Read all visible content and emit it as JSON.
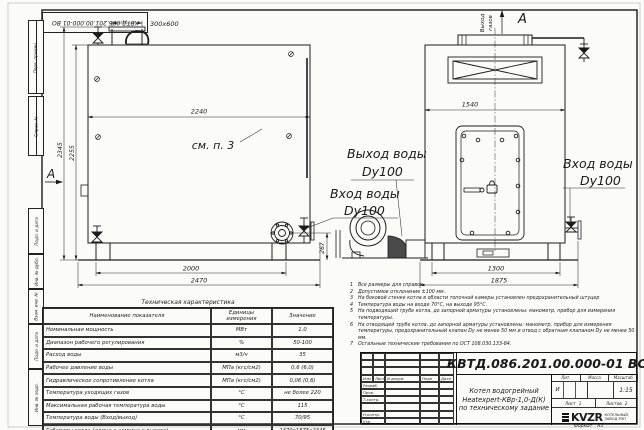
{
  "doc": {
    "number": "КВТД.086.201.00.000-01 ВО",
    "format_label": "Формат",
    "format_value": "А3"
  },
  "margin_labels": {
    "perv_primen": "Перв. примен.",
    "sprav_no": "Справ. №",
    "podp_data_1": "Подп. и дата",
    "inv_dubl": "Инв. № дубл.",
    "vzam_inv": "Взам. инв. №",
    "podp_data_2": "Подп. и дата",
    "inv_podl": "Инв. № подл."
  },
  "drawing": {
    "left_view": {
      "dim_chimney": "300x600",
      "dim_top_width": "2240",
      "see_note": "см. п. 3",
      "dim_height_outer": "2345",
      "dim_height_inner": "2255",
      "view_mark": "А",
      "dim_bottom_inner": "2000",
      "dim_bottom_outer": "2470",
      "dim_flange_height": "267"
    },
    "right_view": {
      "gas_outlet_line1": "Выход",
      "gas_outlet_line2": "газов",
      "view_label": "А",
      "dim_top_width": "1540",
      "dim_bottom_inner": "1300",
      "dim_bottom_outer": "1875"
    },
    "callouts": {
      "water_outlet": "Выход воды",
      "water_outlet_dn": "Dy100",
      "water_inlet_left": "Вход воды",
      "water_inlet_left_dn": "Dy100",
      "water_inlet_right": "Вход воды",
      "water_inlet_right_dn": "Dy100"
    }
  },
  "notes": [
    {
      "n": "1",
      "text": "Все размеры для справок"
    },
    {
      "n": "2",
      "text": "Допустимое отклонение ±100 мм."
    },
    {
      "n": "3",
      "text": "На боковой стенке котла в области топочной камеры установлен предохранительный штуцер"
    },
    {
      "n": "4",
      "text": "Температура воды на входе 70°С, на выходе 95°С."
    },
    {
      "n": "5",
      "text": "На подводящей трубе котла, до запорной арматуры установлены: манометр, прибор для измерения температуры."
    },
    {
      "n": "6",
      "text": "На отводящей трубе котла, до запорной арматуры установлены: манометр, прибор для измерения температуры, предохранительный клапан Dу не менее 50 мм и отвод с обратным клапаном Dу не менее 50 мм."
    },
    {
      "n": "7",
      "text": "Остальные технические требования по ОСТ 108.030.133-84."
    }
  ],
  "spec_table": {
    "title": "Техническая характеристика",
    "headers": [
      "Наименование показателя",
      "Единицы измерения",
      "Значение"
    ],
    "rows": [
      [
        "Номинальная мощность",
        "МВт",
        "1,0"
      ],
      [
        "Диапазон рабочего регулирования",
        "%",
        "50-100"
      ],
      [
        "Расход воды",
        "м3/ч",
        "35"
      ],
      [
        "Рабочее давление воды",
        "МПа (кгс/см2)",
        "0,6 (6,0)"
      ],
      [
        "Гидравлическое сопротивление котла",
        "МПа (кгс/см2)",
        "0,06 (0,6)"
      ],
      [
        "Температура уходящих газов",
        "°С",
        "не более 220"
      ],
      [
        "Максимальная рабочая температура воды",
        "°С",
        "115"
      ],
      [
        "Температура воды (Вход/выход)",
        "°С",
        "70/95"
      ],
      [
        "Габариты котла (длина х ширина х высота)",
        "мм",
        "2470х1875х2345"
      ]
    ]
  },
  "titleblock": {
    "rev_headers": [
      "Изм",
      "Лист",
      "N докум.",
      "Подп",
      "Дата"
    ],
    "sign_rows": [
      "Разраб.",
      "Пров.",
      "Т.контр.",
      "",
      "Н.контр.",
      "Утв."
    ],
    "product_line1": "Котел водогрейный",
    "product_line2": "Heatexpert-КВр-1,0-Д(К)",
    "product_line3": "по техническому задание",
    "lit_label": "Лит.",
    "lit_value": "И",
    "mass_label": "Масса",
    "scale_label": "Масштаб",
    "scale_value": "1:15",
    "sheet_label": "Лист",
    "sheet_value": "1",
    "sheets_label": "Листов",
    "sheets_value": "2",
    "logo_text": "KVZR",
    "logo_sub1": "КОТЕЛЬНЫЙ",
    "logo_sub2": "ЗАВОД РЭП"
  }
}
